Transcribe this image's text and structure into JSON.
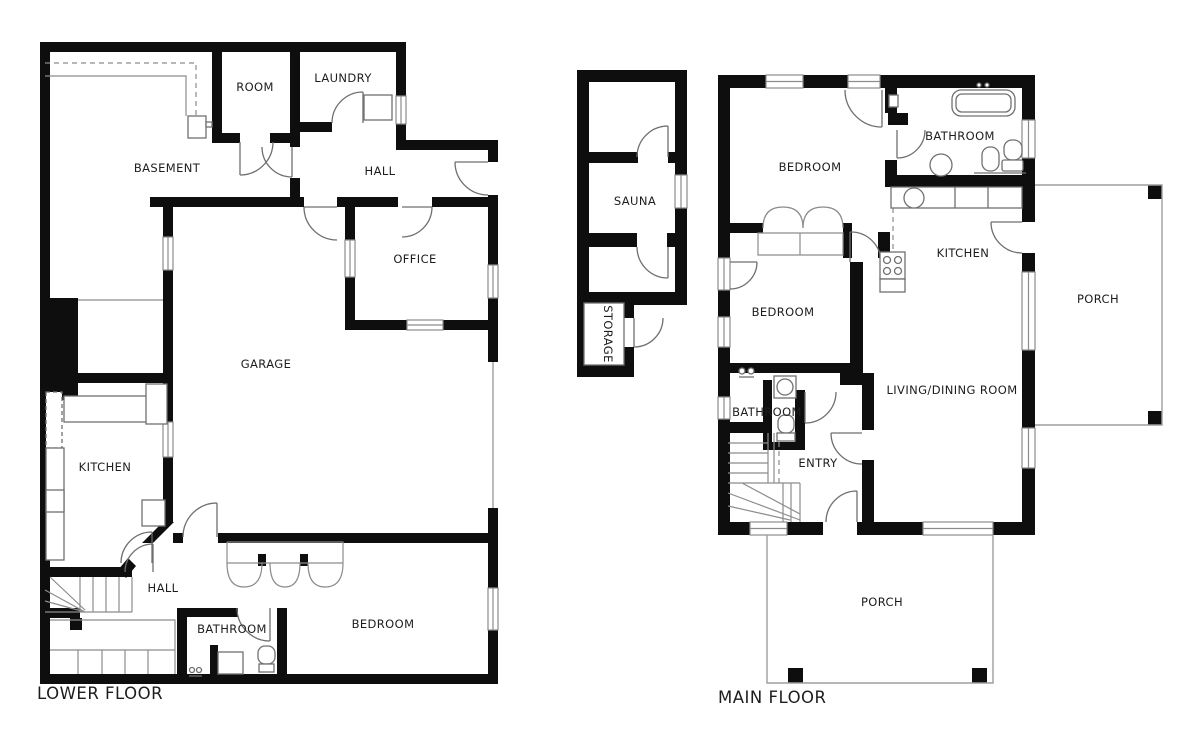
{
  "document": {
    "type": "architectural floor plan, two storeys, black walls on white background"
  },
  "colors": {
    "wall": "#0e0e0e",
    "window_line": "#8c8c8c",
    "door_line": "#6f6f6f",
    "thin_line": "#8c8c8c",
    "fixture_line": "#707070",
    "porch_line": "#9e9e9e",
    "text": "#1d1d1d",
    "background": "#ffffff"
  },
  "lower_floor": {
    "title": "LOWER FLOOR",
    "rooms": [
      {
        "label": "BASEMENT"
      },
      {
        "label": "ROOM"
      },
      {
        "label": "LAUNDRY"
      },
      {
        "label": "HALL"
      },
      {
        "label": "OFFICE"
      },
      {
        "label": "GARAGE"
      },
      {
        "label": "KITCHEN"
      },
      {
        "label": "HALL"
      },
      {
        "label": "BATHROOM"
      },
      {
        "label": "BEDROOM"
      }
    ]
  },
  "main_floor": {
    "title": "MAIN FLOOR",
    "rooms": [
      {
        "label": "SAUNA"
      },
      {
        "label": "STORAGE"
      },
      {
        "label": "BEDROOM"
      },
      {
        "label": "BATHROOM"
      },
      {
        "label": "KITCHEN"
      },
      {
        "label": "BEDROOM"
      },
      {
        "label": "BATHROOM"
      },
      {
        "label": "ENTRY"
      },
      {
        "label": "LIVING/DINING ROOM"
      },
      {
        "label": "PORCH"
      },
      {
        "label": "PORCH"
      }
    ]
  }
}
